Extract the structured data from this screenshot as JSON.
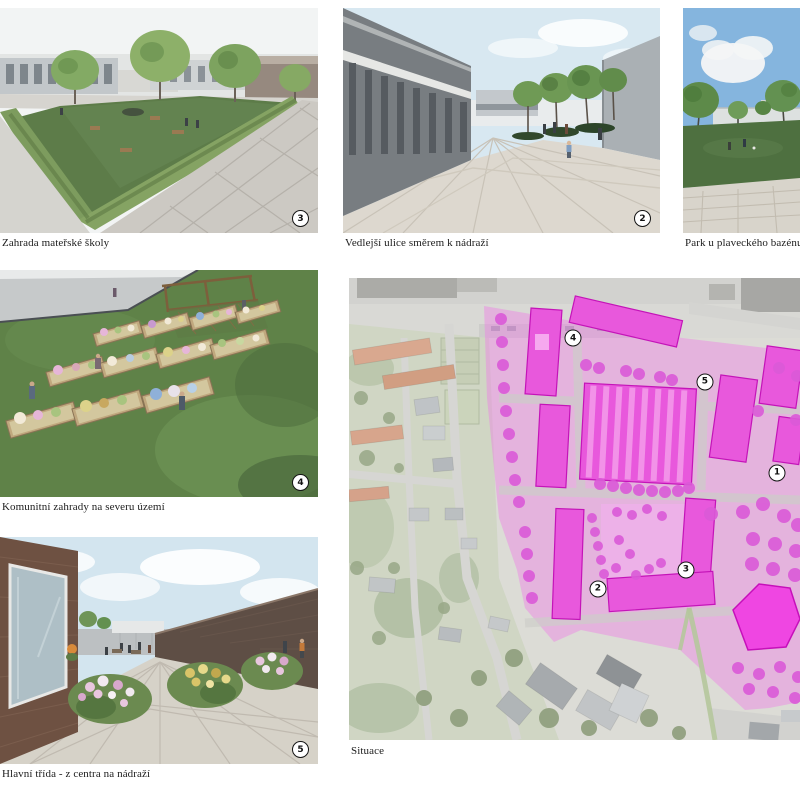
{
  "panels": {
    "kindergarten_garden": {
      "caption": "Zahrada mateřské školy",
      "badge": "3"
    },
    "side_street": {
      "caption": "Vedlejší ulice směrem k nádraží",
      "badge": "2"
    },
    "pool_park": {
      "caption": "Park u plaveckého bazénu"
    },
    "community_gardens": {
      "caption": "Komunitní zahrady na severu území",
      "badge": "4"
    },
    "main_street": {
      "caption": "Hlavní třída - z centra na nádraží",
      "badge": "5"
    },
    "site_plan": {
      "caption": "Situace",
      "markers": [
        {
          "label": "4",
          "x": 49.7,
          "y": 13.0
        },
        {
          "label": "5",
          "x": 78.9,
          "y": 22.5
        },
        {
          "label": "1",
          "x": 94.9,
          "y": 42.2
        },
        {
          "label": "3",
          "x": 74.7,
          "y": 63.2
        },
        {
          "label": "2",
          "x": 55.2,
          "y": 67.3
        }
      ]
    }
  },
  "colors": {
    "overlay_pink": "#ee7ae8",
    "building_magenta": "#e858dc",
    "building_stroke": "#c414b8",
    "tree_dot": "#db5ad8",
    "badge_border": "#141414"
  }
}
